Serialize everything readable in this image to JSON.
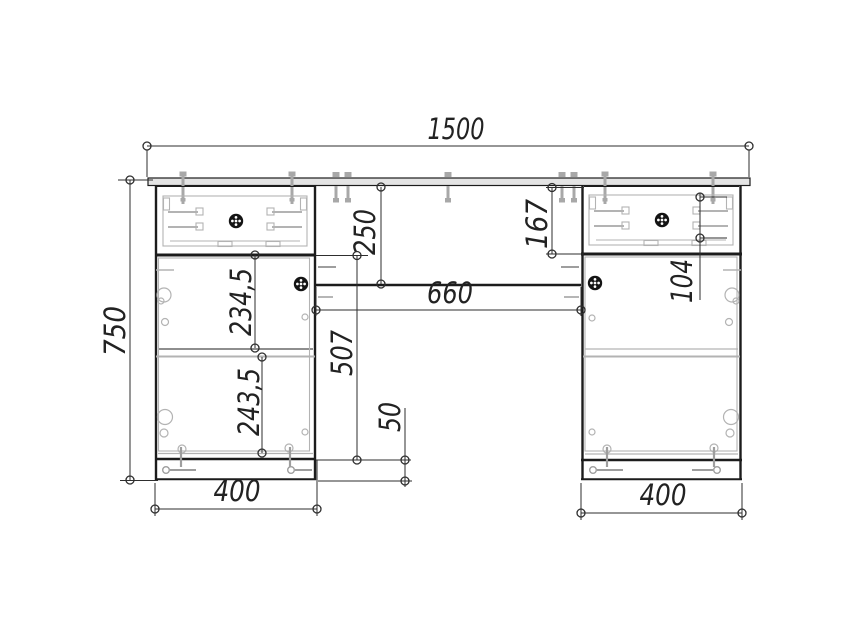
{
  "drawing": {
    "type": "furniture-dimension-drawing",
    "dims": {
      "overall_width": "1500",
      "overall_height": "750",
      "middle_panel_height": "250",
      "right_drawer_height": "167",
      "right_drawer_box_height": "104",
      "knee_space_width": "660",
      "left_shelf_upper": "234,5",
      "left_shelf_lower": "243,5",
      "left_door_opening": "507",
      "plinth_height": "50",
      "left_pedestal_width": "400",
      "right_pedestal_width": "400"
    },
    "colors": {
      "background": "#ffffff",
      "main_line": "#1c1c1c",
      "detail_line": "#b3b3b3",
      "dimension_line": "#2e2e2e",
      "desktop_fill": "#e4e4e4",
      "knob_fill": "#141414"
    }
  }
}
